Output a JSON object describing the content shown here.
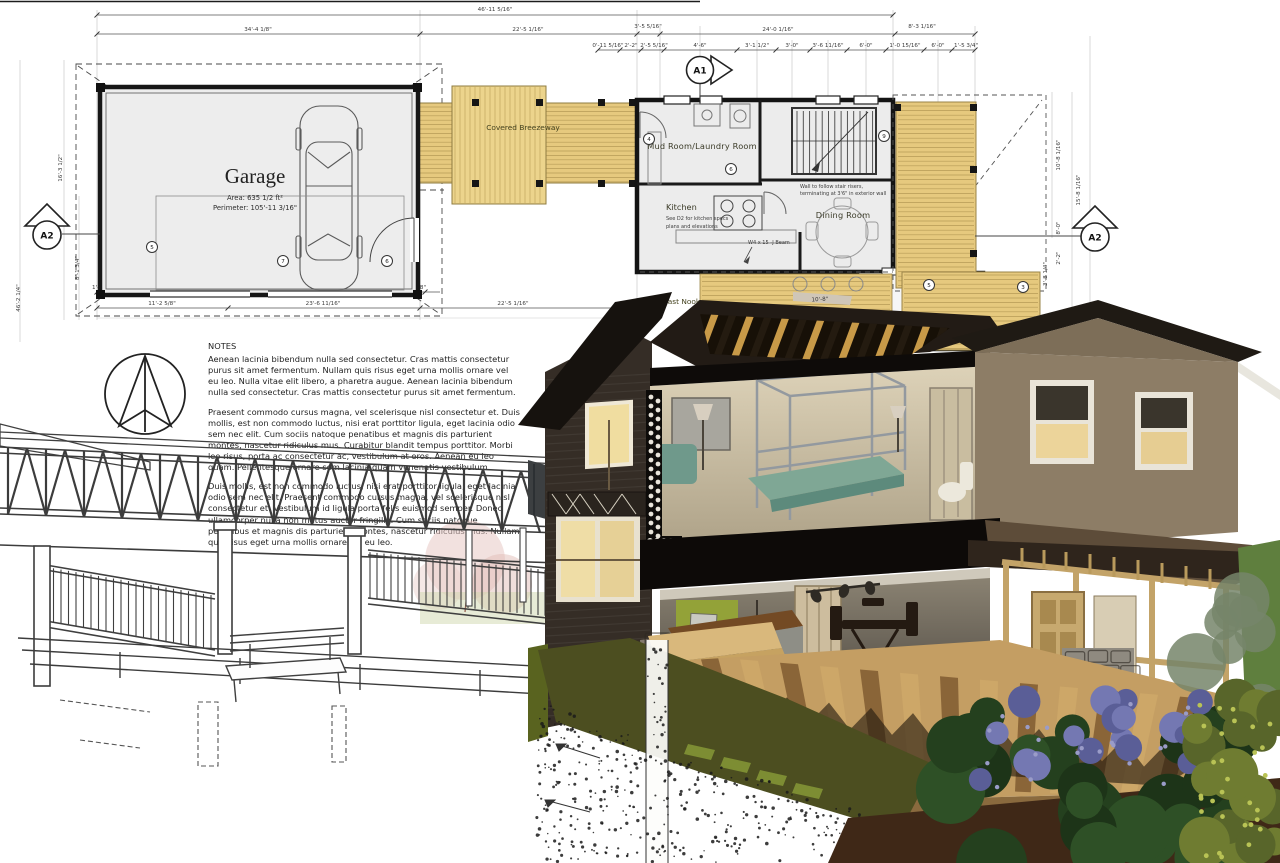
{
  "plan": {
    "garage": {
      "name": "Garage",
      "area": "Area: 635 1/2 ft²",
      "perimeter": "Perimeter: 105'-11 3/16\""
    },
    "rooms": {
      "breezeway": "Covered Breezeway",
      "mud_room": "Mud Room/Laundry Room",
      "kitchen": "Kitchen",
      "kitchen_note1": "See D2 for kitchen specs",
      "kitchen_note2": "plans and elevations",
      "dining": "Dining Room",
      "den": "Den",
      "breakfast_nook": "Breakfast Nook"
    },
    "annotations": {
      "beam": "W4 x 15 -J Beam",
      "stair_wall1": "Wall to follow stair risers,",
      "stair_wall2": "terminating at 3'6\" in exterior wall"
    },
    "markers": {
      "a1": "A1",
      "a2": "A2"
    },
    "keynotes": {
      "3": "3",
      "4": "4",
      "5": "5",
      "6": "6",
      "7": "7",
      "9": "9"
    },
    "dimensions": {
      "overall_top": "46'-11 5/16\"",
      "top": [
        "34'-4 1/8\"",
        "22'-5 1/16\"",
        "3'-5 5/16\"",
        "24'-0 1/16\"",
        "8'-3 1/16\""
      ],
      "top_small": [
        "0'-11 5/16\"",
        "2'-2\"",
        "2'-5 5/16\"",
        "4'-6\"",
        "3'-1 1/2\"",
        "3'-0\"",
        "3'-6 11/16\"",
        "6'-0\"",
        "1'-0 15/16\"",
        "6'-0\"",
        "1'-5 3/4\""
      ],
      "bottom_small": [
        "1'-0 3/4\"",
        "4'-1\"",
        "1'-0 15/16\"",
        "16'-1\"",
        "2'-10 9/16\"",
        "9'-2\"",
        "1'-2 5/8\""
      ],
      "bottom": [
        "11'-2 5/8\"",
        "23'-6 11/16\"",
        "22'-5 1/16\""
      ],
      "left": [
        "16'-3 1/2\"",
        "8'-1 3/4\"",
        "46'-2 1/4\""
      ],
      "right": [
        "10'-8 1/16\"",
        "15'-8 1/16\"",
        "8'-0\"",
        "2'-2\"",
        "3'-8 1/4\"",
        "48'-0 1/8\""
      ],
      "kitchen": "12'-8\"",
      "dining_w": "14'-4 3/8\"",
      "dining_h": "17'-11 1/2\"",
      "roof": "10'-8\""
    }
  },
  "notes": {
    "heading": "NOTES",
    "p1": "Aenean lacinia bibendum nulla sed consectetur. Cras mattis consectetur purus sit amet fermentum. Nullam quis risus eget urna mollis ornare vel eu leo. Nulla vitae elit libero, a pharetra augue. Aenean lacinia bibendum nulla sed consectetur. Cras mattis consectetur purus sit amet fermentum.",
    "p2": "Praesent commodo cursus magna, vel scelerisque nisl consectetur et. Duis mollis, est non commodo luctus, nisi erat porttitor ligula, eget lacinia odio sem nec elit. Cum sociis natoque penatibus et magnis dis parturient montes, nascetur ridiculus mus. Curabitur blandit tempus porttitor. Morbi leo risus, porta ac consectetur ac, vestibulum at eros. Aenean eu leo quam. Pellentesque ornare sem lacinia quam venenatis vestibulum.",
    "p3": "Duis mollis, est non commodo luctus, nisi erat porttitor ligula, eget lacinia odio sem nec elit. Praesent commodo cursus magna, vel scelerisque nisl consectetur et. Vestibulum id ligula porta felis euismod semper. Donec ullamcorper nulla non metus auctor fringilla. Cum sociis natoque penatibus et magnis dis parturient montes, nascetur ridiculus mus. Nullam quis risus eget urna mollis ornare vel eu leo."
  }
}
